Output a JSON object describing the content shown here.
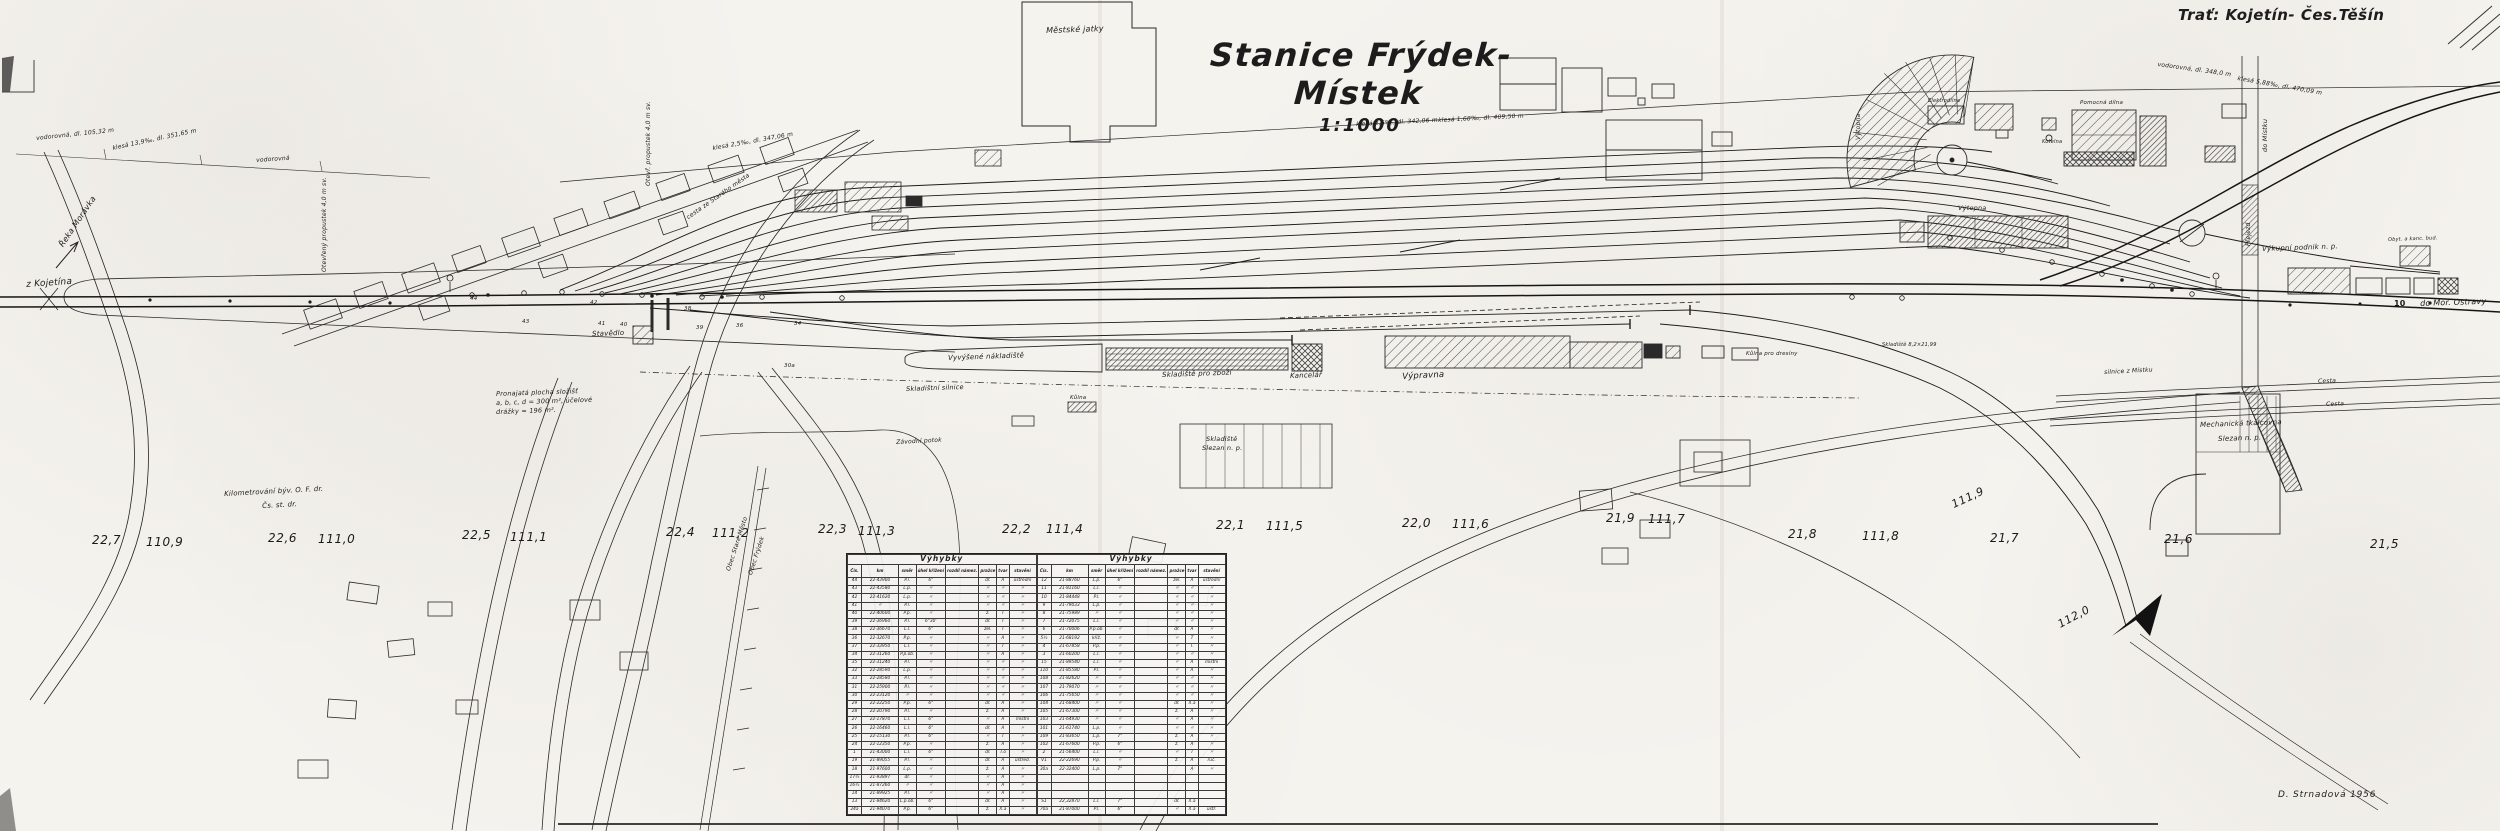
{
  "doc": {
    "station_title": "Stanice Frýdek-Místek",
    "scale_label": "1:1000",
    "route_label": "Trať: Kojetín- Čes.Těšín",
    "signature": "D. Strnadová 1956"
  },
  "colors": {
    "paper": "#f5f3ee",
    "ink": "#1c1c1c"
  },
  "switch_table": {
    "title": "Výhybky",
    "columns": [
      "Čís.",
      "km",
      "směr",
      "úhel křížení",
      "rozdíl námez.",
      "pražce",
      "tvar",
      "stavění"
    ],
    "left_rows": [
      [
        "44",
        "22·43900",
        "P.l.",
        "6°",
        "",
        "dř.",
        "A",
        "ústřední"
      ],
      [
        "43",
        "22·43580",
        "L.p.",
        "〃",
        "",
        "〃",
        "〃",
        "〃"
      ],
      [
        "42",
        "22·41620",
        "L.p.",
        "〃",
        "",
        "〃",
        "〃",
        "〃"
      ],
      [
        "41",
        "〃",
        "P.l.",
        "〃",
        "",
        "〃",
        "〃",
        "〃"
      ],
      [
        "40",
        "22·40600",
        "P.p.",
        "〃",
        "",
        "ž.",
        "T",
        "〃"
      ],
      [
        "39",
        "22·36960",
        "P.l.",
        "6°30'",
        "",
        "dř.",
        "T",
        "〃"
      ],
      [
        "38",
        "22·36670",
        "L.l.",
        "6°",
        "",
        "žel.",
        "T",
        "〃"
      ],
      [
        "36",
        "22·32670",
        "P.p.",
        "〃",
        "",
        "〃",
        "A",
        "〃"
      ],
      [
        "37",
        "22·33950",
        "L.l.",
        "〃",
        "",
        "〃",
        "T",
        "〃"
      ],
      [
        "34",
        "22·31260",
        "P.p.ob.",
        "〃",
        "",
        "〃",
        "A",
        "〃"
      ],
      [
        "35",
        "22·31240",
        "P.l.",
        "〃",
        "",
        "〃",
        "〃",
        "〃"
      ],
      [
        "32",
        "22·28590",
        "L.p.",
        "〃",
        "",
        "〃",
        "〃",
        "〃"
      ],
      [
        "33",
        "22·28580",
        "P.l.",
        "〃",
        "",
        "〃",
        "〃",
        "〃"
      ],
      [
        "31",
        "22·25900",
        "P.l.",
        "〃",
        "",
        "〃",
        "〃",
        "〃"
      ],
      [
        "30",
        "22·23120",
        "〃",
        "〃",
        "",
        "〃",
        "〃",
        "〃"
      ],
      [
        "29",
        "22·22250",
        "P.p.",
        "6°",
        "",
        "dř.",
        "A",
        "〃"
      ],
      [
        "28",
        "22·20790",
        "P.l.",
        "〃",
        "",
        "ž.",
        "A",
        "〃"
      ],
      [
        "27",
        "22·17870",
        "L.l.",
        "6°",
        "",
        "〃",
        "A",
        "místní"
      ],
      [
        "26",
        "22·16460",
        "L.l.",
        "6°",
        "",
        "dř.",
        "A",
        "〃"
      ],
      [
        "25",
        "22·15130",
        "P.l.",
        "6°",
        "",
        "〃",
        "T",
        "〃"
      ],
      [
        "24",
        "22·12350",
        "P.p.",
        "〃",
        "",
        "ž.",
        "A",
        "〃"
      ],
      [
        "1",
        "21·43000",
        "L.l.",
        "6°",
        "",
        "dř.",
        "T.o",
        "〃"
      ],
      [
        "19",
        "21·89055",
        "P.l.",
        "〃",
        "",
        "dř.",
        "A",
        "ústřed."
      ],
      [
        "18",
        "21·97600",
        "L.p.",
        "〃",
        "",
        "ž.",
        "A",
        "〃"
      ],
      [
        "17½",
        "21·93897",
        "dř.",
        "〃",
        "",
        "〃",
        "A",
        "〃"
      ],
      [
        "16½",
        "21·87260",
        "〃",
        "〃",
        "",
        "〃",
        "A",
        "〃"
      ],
      [
        "14",
        "21·89925",
        "P.l.",
        "〃",
        "",
        "〃",
        "A",
        "〃"
      ],
      [
        "13",
        "21·84620",
        "L.p.ob.",
        "6°",
        "",
        "dř.",
        "A",
        "〃"
      ],
      [
        "24a",
        "21·94070",
        "P.p.",
        "6°",
        "",
        "ž.",
        "X.a",
        "〃"
      ]
    ],
    "right_rows": [
      [
        "12",
        "21·88760",
        "L.p.",
        "6°",
        "",
        "žel.",
        "A",
        "ústřední"
      ],
      [
        "11",
        "21·81160",
        "L.l.",
        "〃",
        "",
        "〃",
        "〃",
        "〃"
      ],
      [
        "10",
        "21·84448",
        "P.l.",
        "〃",
        "",
        "〃",
        "〃",
        "〃"
      ],
      [
        "9",
        "21·79033",
        "L.p.",
        "〃",
        "",
        "〃",
        "〃",
        "〃"
      ],
      [
        "8",
        "21·75989",
        "〃",
        "〃",
        "",
        "〃",
        "〃",
        "〃"
      ],
      [
        "7",
        "21·72075",
        "L.l.",
        "〃",
        "",
        "〃",
        "〃",
        "〃"
      ],
      [
        "6",
        "21·70006",
        "P.p.ob.",
        "〃",
        "",
        "dř.",
        "A",
        "〃"
      ],
      [
        "5½",
        "21·68192",
        "křiž.",
        "〃",
        "",
        "〃",
        "T",
        "〃"
      ],
      [
        "4",
        "21·67858",
        "P.p.",
        "〃",
        "",
        "〃",
        "T.",
        "〃"
      ],
      [
        "3",
        "21·60200",
        "L.l.",
        "〃",
        "",
        "〃",
        "〃",
        "〃"
      ],
      [
        "15",
        "21·89540",
        "L.l.",
        "〃",
        "",
        "〃",
        "A",
        "místní"
      ],
      [
        "110",
        "21·85580",
        "P.l.",
        "〃",
        "",
        "〃",
        "A",
        "〃"
      ],
      [
        "108",
        "21·82620",
        "〃",
        "〃",
        "",
        "〃",
        "〃",
        "〃"
      ],
      [
        "107",
        "21·79070",
        "〃",
        "〃",
        "",
        "〃",
        "〃",
        "〃"
      ],
      [
        "106",
        "21·75650",
        "〃",
        "〃",
        "",
        "〃",
        "〃",
        "〃"
      ],
      [
        "104",
        "21·68400",
        "〃",
        "〃",
        "",
        "dř.",
        "X.a",
        "〃"
      ],
      [
        "105",
        "21·67300",
        "〃",
        "〃",
        "",
        "ž.",
        "A",
        "〃"
      ],
      [
        "103",
        "21·64930",
        "〃",
        "〃",
        "",
        "〃",
        "A",
        "〃"
      ],
      [
        "101",
        "21·61740",
        "L.p.",
        "〃",
        "",
        "〃",
        "〃",
        "〃"
      ],
      [
        "109",
        "21·83650",
        "L.p.",
        "7°",
        "",
        "ž.",
        "A",
        "〃"
      ],
      [
        "102",
        "21·67600",
        "P.p.",
        "6°",
        "",
        "ž.",
        "A",
        "〃"
      ],
      [
        "2",
        "21·56400",
        "L.l.",
        "〃",
        "",
        "〃",
        "T",
        "〃"
      ],
      [
        "V1",
        "22·22690",
        "P.p.",
        "〃",
        "",
        "ž.",
        "A",
        "ruč."
      ],
      [
        "30a",
        "22·32400",
        "L.p.",
        "7°",
        "",
        "",
        "A",
        "〃"
      ],
      [
        "",
        "",
        "",
        "",
        "",
        "",
        "",
        ""
      ],
      [
        "",
        "",
        "",
        "",
        "",
        "",
        "",
        ""
      ],
      [
        "",
        "",
        "",
        "",
        "",
        "",
        "",
        ""
      ],
      [
        "S1",
        "22,32870",
        "L.l.",
        "7°",
        "",
        "dř.",
        "X.a",
        ""
      ],
      [
        "70a",
        "21·87000",
        "P.l.",
        "6°",
        "",
        "〃",
        "X.a",
        "ústř."
      ]
    ]
  },
  "map_labels": [
    {
      "n": "label-mestske-jatky",
      "t": "Městské jatky",
      "x": 1046,
      "y": 27,
      "s": 8,
      "r": -2
    },
    {
      "n": "label-z-kojetina",
      "t": "z Kojetína",
      "x": 26,
      "y": 281,
      "s": 9,
      "r": -4
    },
    {
      "n": "label-reka-moravka",
      "t": "Řeka Morávka",
      "x": 58,
      "y": 244,
      "s": 8,
      "r": -56
    },
    {
      "n": "grade-annotation",
      "t": "vodorovná, dl. 105,32 m",
      "x": 36,
      "y": 136,
      "s": 6,
      "r": -6
    },
    {
      "n": "grade-annotation",
      "t": "klesá 13,9‰, dl. 351,65 m",
      "x": 112,
      "y": 146,
      "s": 6,
      "r": -12
    },
    {
      "n": "grade-annotation",
      "t": "vodorovná",
      "x": 256,
      "y": 158,
      "s": 6,
      "r": -4
    },
    {
      "n": "label-propustek",
      "t": "Otevřený propustek 4,0 m sv.",
      "x": 322,
      "y": 272,
      "s": 6,
      "c": "vert"
    },
    {
      "n": "label-propustek",
      "t": "Otevř. propustek 4,0 m sv.",
      "x": 646,
      "y": 186,
      "s": 6,
      "c": "vert"
    },
    {
      "n": "grade-annotation",
      "t": "klesá 2,5‰, dl. 347,06 m",
      "x": 712,
      "y": 146,
      "s": 6,
      "r": -10
    },
    {
      "n": "label-cesta-stare-mesto",
      "t": "cesta ze Starého města",
      "x": 686,
      "y": 216,
      "s": 6,
      "r": -35
    },
    {
      "n": "grade-annotation",
      "t": "klesá 2,5‰, dl. 342,06 m",
      "x": 1356,
      "y": 122,
      "s": 6,
      "r": -3
    },
    {
      "n": "grade-annotation",
      "t": "klesá 1,68‰, dl. 409,50 m",
      "x": 1438,
      "y": 118,
      "s": 6,
      "r": -3
    },
    {
      "n": "label-stavedlo",
      "t": "Stavědlo",
      "x": 592,
      "y": 331,
      "s": 7,
      "r": -2
    },
    {
      "n": "note-pronajata-plocha",
      "t": "Pronajatá plocha složišť",
      "x": 496,
      "y": 391,
      "s": 6.5,
      "r": -2
    },
    {
      "n": "note-pronajata-plocha",
      "t": "a, b, c, d = 300 m², účelové",
      "x": 496,
      "y": 400,
      "s": 6.5,
      "r": -2
    },
    {
      "n": "note-pronajata-plocha",
      "t": "drážky = 196 m².",
      "x": 496,
      "y": 409,
      "s": 6.5,
      "r": -2
    },
    {
      "n": "note-kilometrovani",
      "t": "Kilometrování býv. O. F. dr.",
      "x": 224,
      "y": 491,
      "s": 7,
      "r": -3
    },
    {
      "n": "note-kilometrovani",
      "t": "Čs. st. dr.",
      "x": 262,
      "y": 503,
      "s": 7,
      "r": -3
    },
    {
      "n": "label-vyvysene-nakladiste",
      "t": "Vyvýšené nákladiště",
      "x": 948,
      "y": 355,
      "s": 7,
      "r": -2
    },
    {
      "n": "label-skladistni-silnice",
      "t": "Skladištní silnice",
      "x": 906,
      "y": 386,
      "s": 6.5,
      "r": -2
    },
    {
      "n": "label-skladiste-pro-zbozi",
      "t": "Skladiště pro zboží",
      "x": 1162,
      "y": 372,
      "s": 7,
      "r": -2
    },
    {
      "n": "label-kancelar",
      "t": "Kancelář",
      "x": 1290,
      "y": 373,
      "s": 7,
      "r": -2
    },
    {
      "n": "label-vypravna",
      "t": "Výpravna",
      "x": 1402,
      "y": 373,
      "s": 8.5,
      "r": -3
    },
    {
      "n": "label-kulna-pro-dresiny",
      "t": "Kůlna pro dresíny",
      "x": 1746,
      "y": 352,
      "s": 5.5
    },
    {
      "n": "label-skladiste",
      "t": "Skladiště 8,2×21,99",
      "x": 1882,
      "y": 343,
      "s": 5
    },
    {
      "n": "label-kulna",
      "t": "Kůlna",
      "x": 1070,
      "y": 396,
      "s": 5.5
    },
    {
      "n": "label-zavodni-potok",
      "t": "Závodní potok",
      "x": 896,
      "y": 440,
      "s": 6,
      "r": -3
    },
    {
      "n": "label-skladiste-slezan",
      "t": "Skladiště",
      "x": 1206,
      "y": 436,
      "s": 6.5
    },
    {
      "n": "label-skladiste-slezan",
      "t": "Slezan n. p.",
      "x": 1202,
      "y": 445,
      "s": 6.5
    },
    {
      "n": "label-obec-stare-mesto",
      "t": "Obec Staré Město",
      "x": 726,
      "y": 570,
      "s": 6,
      "r": -72
    },
    {
      "n": "label-obec-frydek",
      "t": "Obec Frýdek",
      "x": 748,
      "y": 574,
      "s": 6,
      "r": -72
    },
    {
      "n": "label-elektrodilna",
      "t": "Elektrodílna",
      "x": 1928,
      "y": 99,
      "s": 5
    },
    {
      "n": "label-pomocna-dilna",
      "t": "Pomocná dílna",
      "x": 2080,
      "y": 101,
      "s": 5.5
    },
    {
      "n": "label-kotelna",
      "t": "Kotelna",
      "x": 2042,
      "y": 140,
      "s": 5
    },
    {
      "n": "label-vytopna",
      "t": "Výtopna",
      "x": 1958,
      "y": 205,
      "s": 6.5
    },
    {
      "n": "label-vytopna",
      "t": "Výtopna",
      "x": 1856,
      "y": 140,
      "s": 6,
      "c": "vert"
    },
    {
      "n": "label-do-mistku",
      "t": "do Místku",
      "x": 2262,
      "y": 152,
      "s": 6.5,
      "c": "vert"
    },
    {
      "n": "label-prejezd",
      "t": "Přejezd",
      "x": 2246,
      "y": 246,
      "s": 6,
      "c": "vert"
    },
    {
      "n": "label-vykupni-podnik",
      "t": "Výkupní podnik n. p.",
      "x": 2262,
      "y": 246,
      "s": 7,
      "r": -2
    },
    {
      "n": "label-obyt-kanc-bud",
      "t": "Obyt. a kanc. bud.",
      "x": 2388,
      "y": 238,
      "s": 5,
      "r": -2
    },
    {
      "n": "label-do-mor-ostravy",
      "t": "do Mor. Ostravy",
      "x": 2420,
      "y": 300,
      "s": 8,
      "r": -2
    },
    {
      "n": "track-number",
      "t": "10",
      "x": 2394,
      "y": 300,
      "s": 8,
      "c": "bold"
    },
    {
      "n": "label-cesta",
      "t": "Cesta",
      "x": 2318,
      "y": 379,
      "s": 6,
      "r": -2
    },
    {
      "n": "label-cesta",
      "t": "Cesta",
      "x": 2326,
      "y": 402,
      "s": 6,
      "r": -2
    },
    {
      "n": "label-silnice-z-mistku",
      "t": "silnice z Místku",
      "x": 2104,
      "y": 370,
      "s": 6,
      "r": -3
    },
    {
      "n": "label-tkalcovna",
      "t": "Mechanická tkalcovna",
      "x": 2200,
      "y": 422,
      "s": 7,
      "r": -2
    },
    {
      "n": "label-tkalcovna",
      "t": "Slezan n. p.",
      "x": 2218,
      "y": 436,
      "s": 7,
      "r": -2
    },
    {
      "n": "grade-annotation",
      "t": "vodorovná, dl. 348,0 m",
      "x": 2158,
      "y": 62,
      "s": 6,
      "r": 8
    },
    {
      "n": "grade-annotation",
      "t": "klesá 5,88‰, dl. 470,09 m",
      "x": 2238,
      "y": 76,
      "s": 6,
      "r": 10
    },
    {
      "n": "km-marker",
      "t": "22,7",
      "x": 92,
      "y": 534,
      "s": 12,
      "c": "km"
    },
    {
      "n": "km-marker",
      "t": "110,9",
      "x": 146,
      "y": 536,
      "s": 12,
      "c": "km"
    },
    {
      "n": "km-marker",
      "t": "22,6",
      "x": 268,
      "y": 532,
      "s": 12,
      "c": "km"
    },
    {
      "n": "km-marker",
      "t": "111,0",
      "x": 318,
      "y": 533,
      "s": 12,
      "c": "km"
    },
    {
      "n": "km-marker",
      "t": "22,5",
      "x": 462,
      "y": 529,
      "s": 12,
      "c": "km"
    },
    {
      "n": "km-marker",
      "t": "111,1",
      "x": 510,
      "y": 531,
      "s": 12,
      "c": "km"
    },
    {
      "n": "km-marker",
      "t": "22,4",
      "x": 666,
      "y": 526,
      "s": 12,
      "c": "km"
    },
    {
      "n": "km-marker",
      "t": "111,2",
      "x": 712,
      "y": 527,
      "s": 12,
      "c": "km"
    },
    {
      "n": "km-marker",
      "t": "22,3",
      "x": 818,
      "y": 523,
      "s": 12,
      "c": "km"
    },
    {
      "n": "km-marker",
      "t": "111,3",
      "x": 858,
      "y": 525,
      "s": 12,
      "c": "km"
    },
    {
      "n": "km-marker",
      "t": "22,2",
      "x": 1002,
      "y": 523,
      "s": 12,
      "c": "km"
    },
    {
      "n": "km-marker",
      "t": "111,4",
      "x": 1046,
      "y": 523,
      "s": 12,
      "c": "km"
    },
    {
      "n": "km-marker",
      "t": "22,1",
      "x": 1216,
      "y": 519,
      "s": 12,
      "c": "km"
    },
    {
      "n": "km-marker",
      "t": "111,5",
      "x": 1266,
      "y": 520,
      "s": 12,
      "c": "km"
    },
    {
      "n": "km-marker",
      "t": "22,0",
      "x": 1402,
      "y": 517,
      "s": 12,
      "c": "km"
    },
    {
      "n": "km-marker",
      "t": "111,6",
      "x": 1452,
      "y": 518,
      "s": 12,
      "c": "km"
    },
    {
      "n": "km-marker",
      "t": "21,9",
      "x": 1606,
      "y": 512,
      "s": 12,
      "c": "km"
    },
    {
      "n": "km-marker",
      "t": "111,7",
      "x": 1648,
      "y": 513,
      "s": 12,
      "c": "km"
    },
    {
      "n": "km-marker",
      "t": "21,8",
      "x": 1788,
      "y": 528,
      "s": 12,
      "c": "km"
    },
    {
      "n": "km-marker",
      "t": "111,8",
      "x": 1862,
      "y": 530,
      "s": 12,
      "c": "km"
    },
    {
      "n": "km-marker",
      "t": "21,7",
      "x": 1990,
      "y": 532,
      "s": 12,
      "c": "km"
    },
    {
      "n": "km-marker",
      "t": "21,6",
      "x": 2164,
      "y": 533,
      "s": 12,
      "c": "km"
    },
    {
      "n": "km-marker",
      "t": "21,5",
      "x": 2370,
      "y": 538,
      "s": 12,
      "c": "km"
    },
    {
      "n": "km-marker",
      "t": "111,9",
      "x": 1950,
      "y": 500,
      "s": 11,
      "r": -25,
      "c": "km"
    },
    {
      "n": "km-marker",
      "t": "112,0",
      "x": 2056,
      "y": 620,
      "s": 11,
      "r": -28,
      "c": "km"
    },
    {
      "n": "switch-number",
      "t": "44",
      "x": 470,
      "y": 297,
      "s": 5.5
    },
    {
      "n": "switch-number",
      "t": "43",
      "x": 522,
      "y": 320,
      "s": 5.5
    },
    {
      "n": "switch-number",
      "t": "42",
      "x": 590,
      "y": 301,
      "s": 5.5
    },
    {
      "n": "switch-number",
      "t": "41",
      "x": 598,
      "y": 322,
      "s": 5.5
    },
    {
      "n": "switch-number",
      "t": "40",
      "x": 620,
      "y": 323,
      "s": 5.5
    },
    {
      "n": "switch-number",
      "t": "39",
      "x": 696,
      "y": 326,
      "s": 5.5
    },
    {
      "n": "switch-number",
      "t": "38",
      "x": 684,
      "y": 307,
      "s": 5.5
    },
    {
      "n": "switch-number",
      "t": "36",
      "x": 736,
      "y": 324,
      "s": 5.5
    },
    {
      "n": "switch-number",
      "t": "34",
      "x": 794,
      "y": 322,
      "s": 5.5
    },
    {
      "n": "switch-number",
      "t": "30a",
      "x": 784,
      "y": 364,
      "s": 5.5
    }
  ]
}
